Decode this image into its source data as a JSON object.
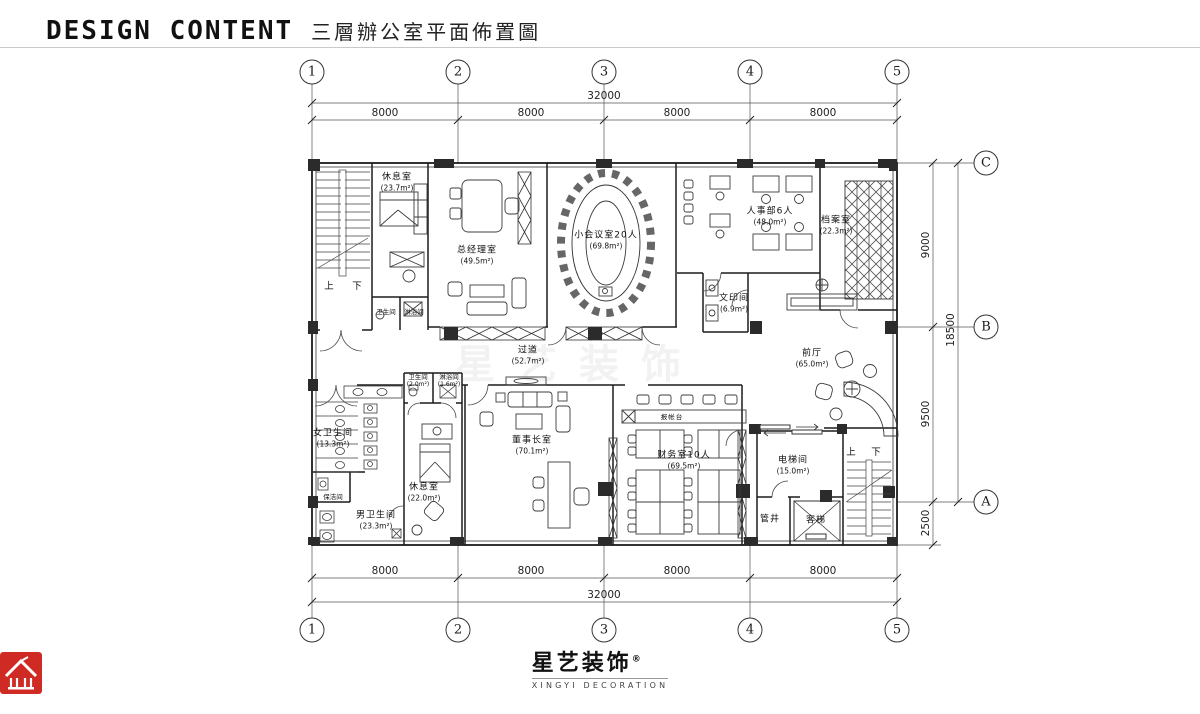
{
  "header": {
    "title_en": "DESIGN CONTENT",
    "title_cn": "三層辦公室平面佈置圖"
  },
  "grid": {
    "cols": [
      "1",
      "2",
      "3",
      "4",
      "5"
    ],
    "rows": [
      "C",
      "B",
      "A"
    ]
  },
  "dimensions": {
    "top": {
      "overall": "32000",
      "segments": [
        "8000",
        "8000",
        "8000",
        "8000"
      ]
    },
    "bottom": {
      "overall": "32000",
      "segments": [
        "8000",
        "8000",
        "8000",
        "8000"
      ]
    },
    "right": {
      "overall": "18500",
      "segments": [
        "9000",
        "9500",
        "2500"
      ]
    }
  },
  "rooms": {
    "rest_top": {
      "name": "休息室",
      "area": "(23.7m²)"
    },
    "gm_office": {
      "name": "总经理室",
      "area": "(49.5m²)"
    },
    "meeting": {
      "name": "小会议室20人",
      "area": "(69.8m²)"
    },
    "hr": {
      "name": "人事部6人",
      "area": "(48.0m²)"
    },
    "archive": {
      "name": "档案室",
      "area": "(22.3m²)"
    },
    "print": {
      "name": "文印间",
      "area": "(6.9m²)"
    },
    "wc_top": {
      "name": "卫生间"
    },
    "shower_top": {
      "name": "淋浴间"
    },
    "corridor": {
      "name": "过道",
      "area": "(52.7m²)"
    },
    "lobby": {
      "name": "前厅",
      "area": "(65.0m²)"
    },
    "wc_women": {
      "name": "女卫生间",
      "area": "(13.3m²)"
    },
    "cleaning": {
      "name": "保洁间"
    },
    "wc_men": {
      "name": "男卫生间",
      "area": "(23.3m²)"
    },
    "wc_small": {
      "name": "卫生间",
      "area": "(2.0m²)"
    },
    "shower_small": {
      "name": "淋浴间",
      "area": "(1.6m²)"
    },
    "rest_bottom": {
      "name": "休息室",
      "area": "(22.0m²)"
    },
    "chairman": {
      "name": "董事长室",
      "area": "(70.1m²)"
    },
    "finance": {
      "name": "财务室10人",
      "area": "(69.5m²)"
    },
    "elevator_hall": {
      "name": "电梯间",
      "area": "(15.0m²)"
    },
    "shaft": {
      "name": "管井"
    },
    "lift": {
      "name": "客梯"
    },
    "counter": {
      "name": "报帐台"
    }
  },
  "stairs": {
    "up": "上",
    "down": "下"
  },
  "watermark": "星艺装饰",
  "logo": {
    "name_cn": "星艺装饰",
    "reg": "®",
    "name_en": "XINGYI DECORATION",
    "red": "#cf2a24"
  }
}
